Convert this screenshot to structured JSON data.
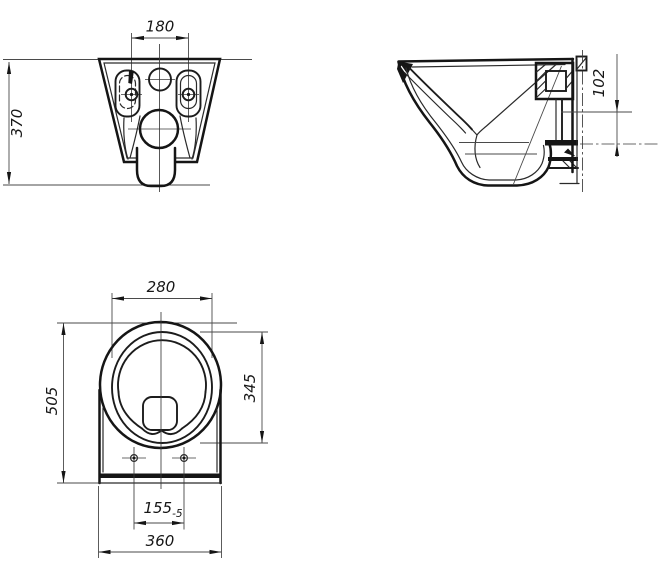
{
  "drawing": {
    "type": "technical-dimension-drawing",
    "subject": "wall-hung toilet bowl, three orthographic views",
    "colors": {
      "line": "#151515",
      "thin_line": "#4a4a4a",
      "background": "#ffffff"
    },
    "dimensions": {
      "rear_mount_hole_spacing": "180",
      "rear_height": "370",
      "side_inlet_to_outlet": "102",
      "plan_bowl_inner_width": "280",
      "plan_overall_length": "505",
      "plan_bowl_inner_length": "345",
      "plan_seat_hole_spacing": "155",
      "plan_seat_hole_tolerance": "-5",
      "plan_overall_width": "360"
    }
  }
}
